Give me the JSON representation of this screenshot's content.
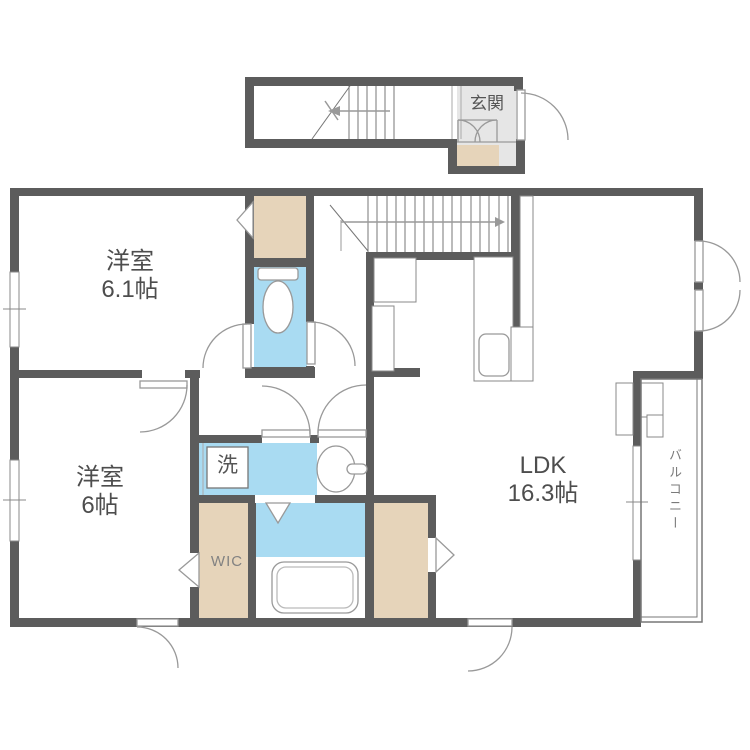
{
  "title": "間取り図",
  "colors": {
    "wall": "#5c5c5c",
    "water": "#a9dbf2",
    "closet": "#e6d4ba",
    "genkan_floor": "#e6e6e6",
    "line": "#999999",
    "thin": "#777777",
    "text": "#4d4d4d",
    "text_muted": "#828282"
  },
  "rooms": {
    "genkan": {
      "label": "玄関"
    },
    "bedroom1": {
      "label": "洋室",
      "size": "6.1帖"
    },
    "bedroom2": {
      "label": "洋室",
      "size": "6帖"
    },
    "ldk": {
      "label": "LDK",
      "size": "16.3帖"
    },
    "wic": {
      "label": "WIC"
    },
    "laundry": {
      "label": "洗"
    },
    "balcony": {
      "label": "バルコニー"
    }
  }
}
